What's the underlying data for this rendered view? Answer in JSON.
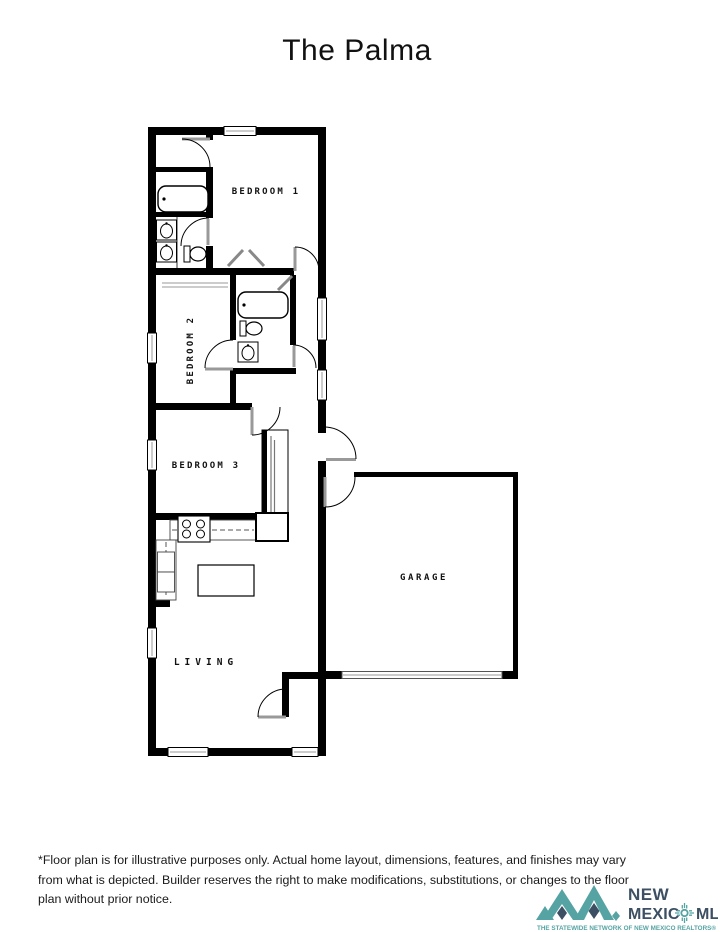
{
  "page": {
    "title": "The Palma"
  },
  "floor_plan": {
    "rooms": [
      {
        "id": "bedroom1",
        "label": "BEDROOM 1"
      },
      {
        "id": "bedroom2",
        "label": "BEDROOM 2"
      },
      {
        "id": "bedroom3",
        "label": "BEDROOM 3"
      },
      {
        "id": "garage",
        "label": "GARAGE"
      },
      {
        "id": "living",
        "label": "LIVING"
      }
    ],
    "colors": {
      "wall": "#000000",
      "door_leaf": "#999999",
      "counter_line": "#555555"
    },
    "fixtures": [
      "bathtub-icon",
      "toilet-icon",
      "sink-icon",
      "stove-icon",
      "kitchen-island",
      "window",
      "door-arc",
      "garage-door",
      "closet-sliding-doors",
      "closet-bifold-doors"
    ]
  },
  "disclaimer": {
    "text": "*Floor plan is for illustrative purposes only. Actual home layout, dimensions, features, and finishes may vary from what is depicted. Builder reserves the right to make modifications, substitutions, or changes to the floor plan without prior notice."
  },
  "logo": {
    "line1": "NEW",
    "line2_left": "MEXIC",
    "line2_right": "MLS",
    "tagline": "THE STATEWIDE NETWORK OF NEW MEXICO REALTORS®",
    "colors": {
      "teal": "#56a3a3",
      "slate": "#3d4f63"
    }
  }
}
